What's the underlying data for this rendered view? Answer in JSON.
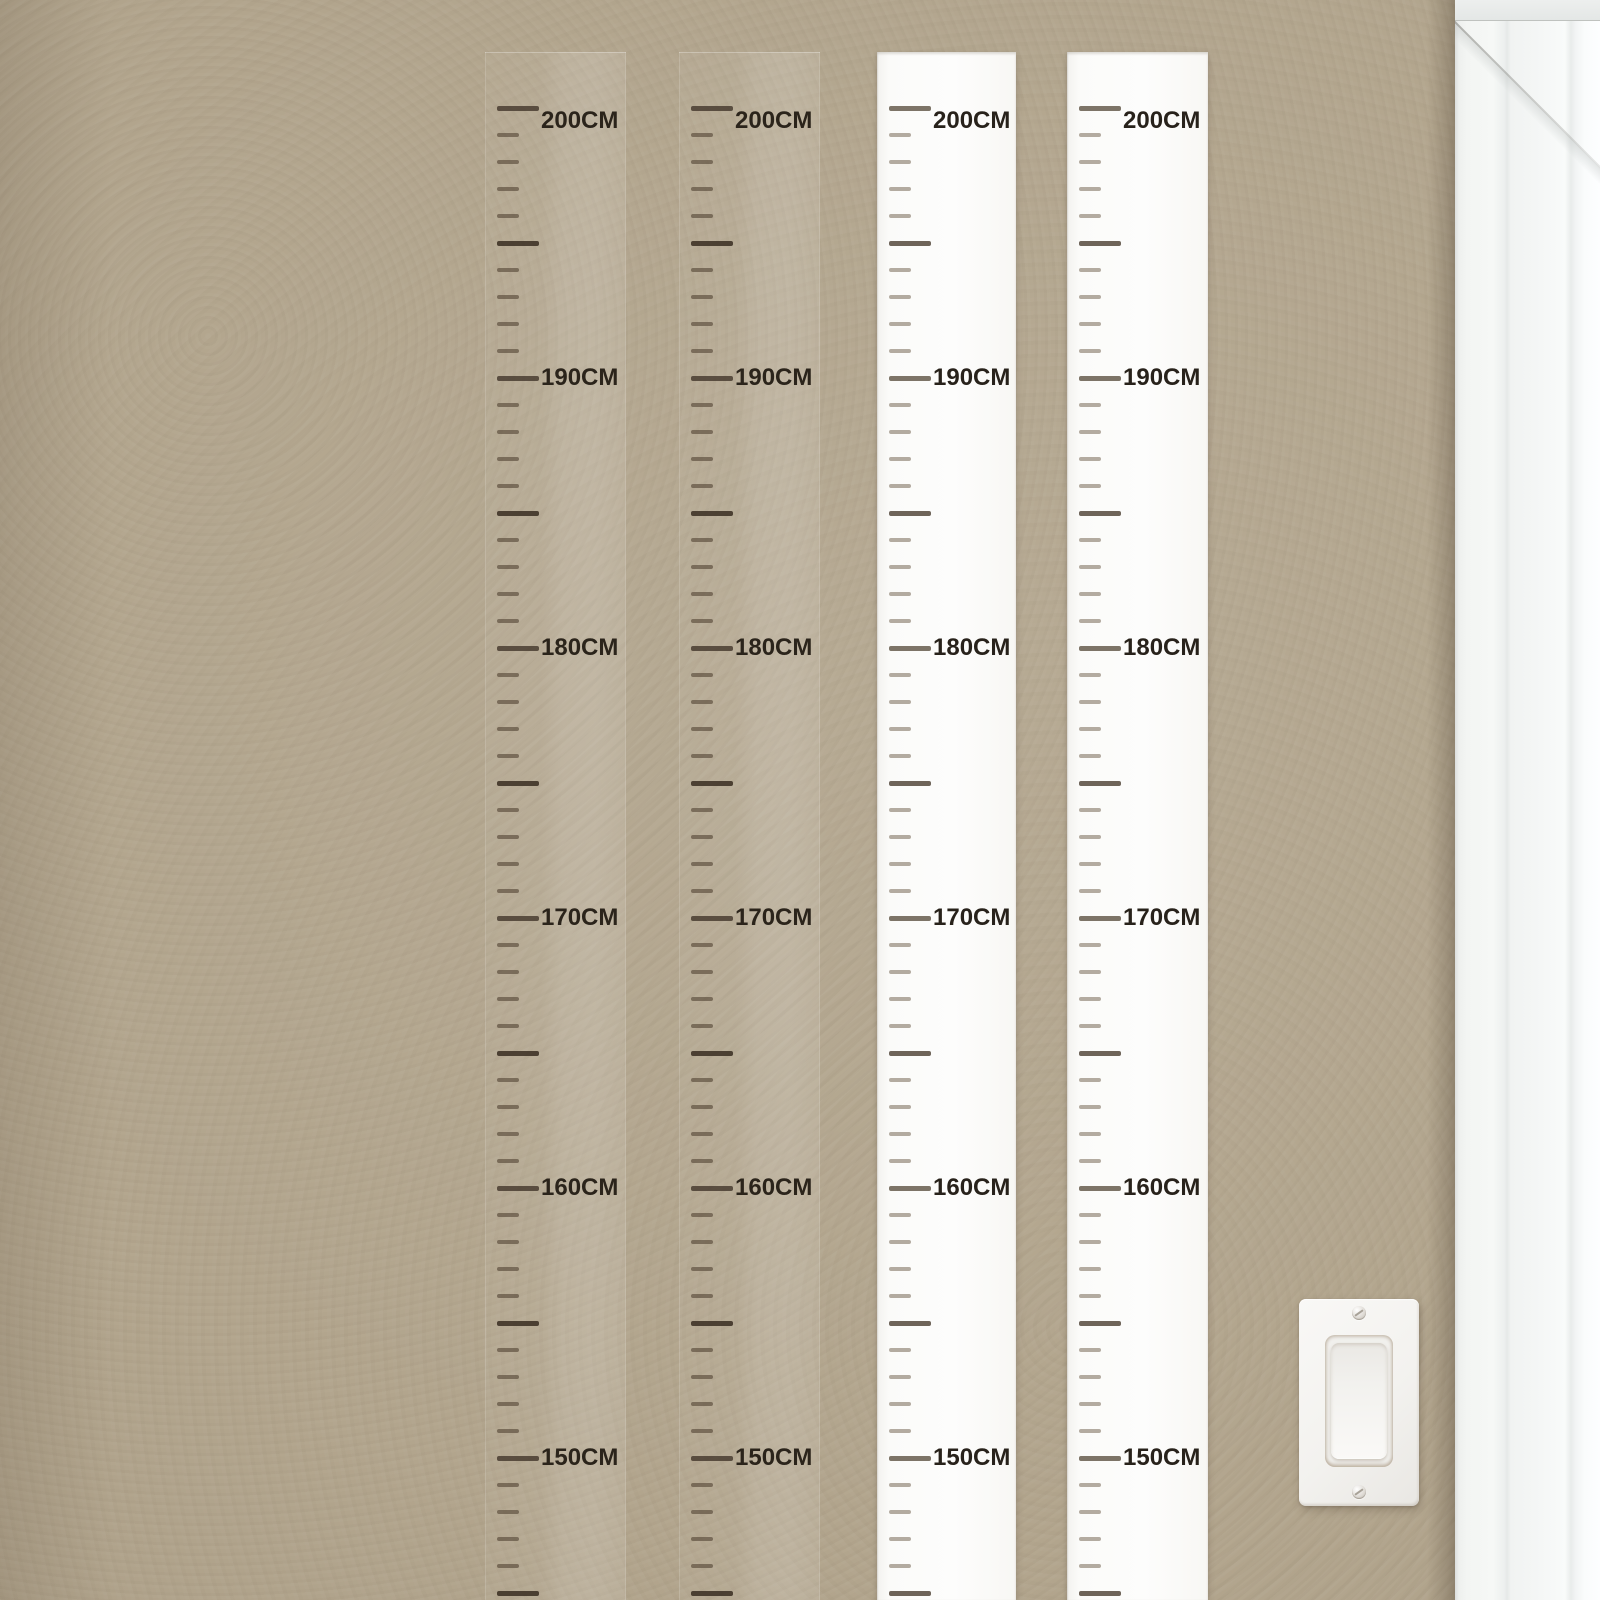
{
  "measurement_chart": {
    "unit_label": "CM",
    "top_value_cm": 200,
    "bottom_value_cm": 143,
    "minor_tick_step_cm": 1,
    "medium_tick_step_cm": 5,
    "labeled_step_cm": 10,
    "labels": [
      "200CM",
      "190CM",
      "180CM",
      "170CM",
      "160CM",
      "150CM"
    ],
    "rulers": [
      {
        "id": "ruler-1",
        "finish": "transparent",
        "x": 485,
        "width": 141
      },
      {
        "id": "ruler-2",
        "finish": "transparent",
        "x": 679,
        "width": 141
      },
      {
        "id": "ruler-3",
        "finish": "white",
        "x": 877,
        "width": 139
      },
      {
        "id": "ruler-4",
        "finish": "white",
        "x": 1067,
        "width": 141
      }
    ],
    "geometry": {
      "top_tick_y": 56,
      "px_per_cm": 27,
      "top_label_shift_y": 13
    },
    "colors": {
      "label_text": "#2b241b",
      "white_ruler_background": "#fcfcfa",
      "transparent_tick": "#54463624",
      "white_minor_tick": "#b3aba0",
      "white_medium_tick": "#6e6459",
      "white_major_tick": "#7d7467"
    }
  },
  "wall": {
    "base_color": "#b2a58d"
  },
  "door_frame": {
    "casing_color": "#f6f8f6",
    "position": "right-edge"
  },
  "light_switch": {
    "style": "rocker",
    "plate_color": "#f3f2ef",
    "screw_count": 2
  }
}
